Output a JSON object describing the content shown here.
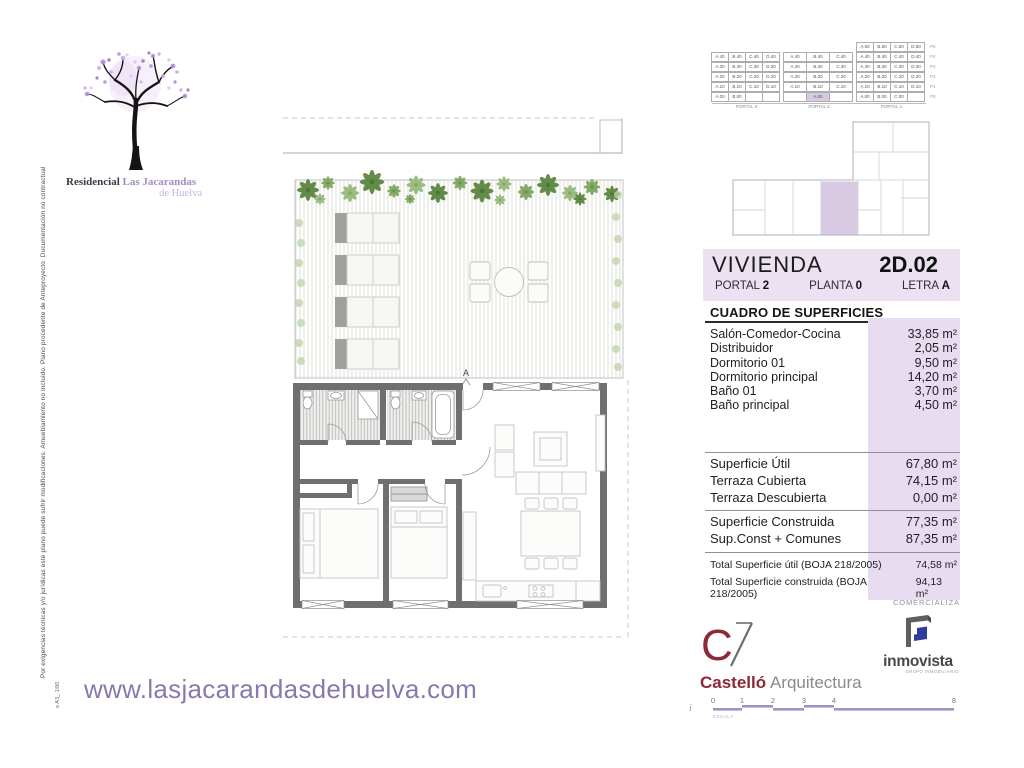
{
  "page": {
    "side_disclaimer": "Por exigencias técnicas y/o jurídicas este plano puede sufrir modificaciones. Amueblamiento no incluido. Plano procedente de Anteproyecto. Documentación no contractual",
    "sheet_code": "e A3_ 1/80",
    "website": "www.lasjacarandasdehuelva.com"
  },
  "logo": {
    "line1": "Residencial",
    "line2": "Las Jacarandas",
    "line3": "de Huelva"
  },
  "plan": {
    "section_marker": "A"
  },
  "unit_matrix": {
    "portal_labels": [
      "PORTAL 3",
      "PORTAL 2",
      "PORTAL 1"
    ],
    "highlight_color": "#d9cae4",
    "rows": [
      {
        "label": "P5",
        "cells": [
          null,
          null,
          null,
          null,
          null,
          null,
          null,
          "A.50",
          "B.50",
          "C.50",
          "D.50"
        ]
      },
      {
        "label": "P4",
        "cells": [
          "A.40",
          "B.40",
          "C.40",
          "D.40",
          "A.40",
          "B.40",
          "C.40",
          "A.40",
          "B.40",
          "C.40",
          "D.40"
        ]
      },
      {
        "label": "P3",
        "cells": [
          "A.30",
          "B.30",
          "C.30",
          "D.30",
          "A.30",
          "B.30",
          "C.30",
          "A.30",
          "B.30",
          "C.30",
          "D.30"
        ]
      },
      {
        "label": "P2",
        "cells": [
          "A.20",
          "B.20",
          "C.20",
          "D.20",
          "A.20",
          "B.20",
          "C.20",
          "A.20",
          "B.20",
          "C.20",
          "D.20"
        ]
      },
      {
        "label": "P1",
        "cells": [
          "A.10",
          "B.10",
          "C.10",
          "D.10",
          "A.10",
          "B.10",
          "C.10",
          "A.10",
          "B.10",
          "C.10",
          "D.10"
        ]
      },
      {
        "label": "P0",
        "cells": [
          "A.00",
          "B.00",
          "",
          "",
          "",
          {
            "t": "A.00",
            "hl": true
          },
          "",
          "A.00",
          "B.00",
          "C.00",
          ""
        ]
      }
    ]
  },
  "info": {
    "vivienda_label": "VIVIENDA",
    "vivienda_code": "2D.02",
    "portal_label": "PORTAL",
    "portal_value": "2",
    "planta_label": "PLANTA",
    "planta_value": "0",
    "letra_label": "LETRA",
    "letra_value": "A",
    "table_title": "CUADRO DE SUPERFICIES",
    "rooms": [
      {
        "label": "Salón-Comedor-Cocina",
        "value": "33,85 m²"
      },
      {
        "label": "Distribuidor",
        "value": "2,05 m²"
      },
      {
        "label": "Dormitorio 01",
        "value": "9,50 m²"
      },
      {
        "label": "Dormitorio principal",
        "value": "14,20 m²"
      },
      {
        "label": "Baño 01",
        "value": "3,70 m²"
      },
      {
        "label": "Baño principal",
        "value": "4,50 m²"
      }
    ],
    "summary1": [
      {
        "label": "Superficie Útil",
        "value": "67,80 m²"
      },
      {
        "label": "Terraza Cubierta",
        "value": "74,15 m²"
      },
      {
        "label": "Terraza Descubierta",
        "value": "0,00 m²"
      }
    ],
    "summary2": [
      {
        "label": "Superficie Construida",
        "value": "77,35 m²"
      },
      {
        "label": "Sup.Const + Comunes",
        "value": "87,35 m²"
      }
    ],
    "totals": [
      {
        "label": "Total Superficie útil (BOJA 218/2005)",
        "value": "74,58 m²"
      },
      {
        "label": "Total Superficie construida (BOJA 218/2005)",
        "value": "94,13 m²"
      }
    ],
    "comercializa": "COMERCIALIZA"
  },
  "brands": {
    "castello": {
      "initial": "C",
      "name1": "Castelló",
      "name2": "Arquitectura"
    },
    "inmovista": {
      "name": "inmovista",
      "subtitle": "GRUPO INMOBILIARIO"
    }
  },
  "scalebar": {
    "ticks": [
      "0",
      "1",
      "2",
      "3",
      "4",
      "8"
    ],
    "label": "ESCALA",
    "prefix": "i"
  },
  "colors": {
    "band_lavender": "#ece1f1",
    "value_strip": "#e8ddf0",
    "highlight_cell": "#d9cae4",
    "website_purple": "#8878ae",
    "castello_maroon": "#8d2837",
    "inmovista_blue": "#2e3ca0",
    "wall_gray": "#6f6f6f",
    "plant_green": "#57833b"
  }
}
